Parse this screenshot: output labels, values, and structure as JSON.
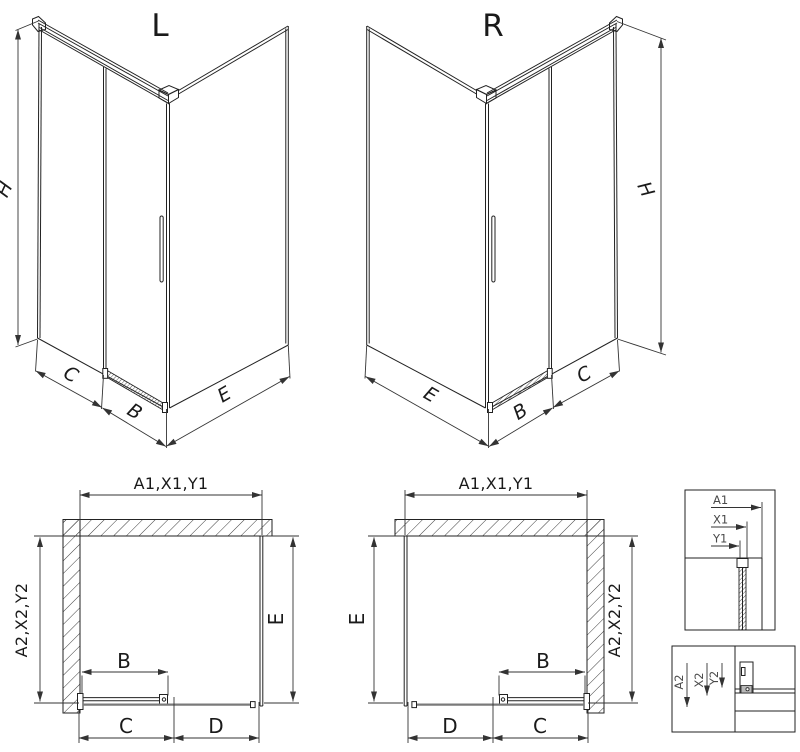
{
  "iso_left": {
    "letter": "L",
    "dim_h": "H",
    "dim_c": "C",
    "dim_b": "B",
    "dim_e": "E"
  },
  "iso_right": {
    "letter": "R",
    "dim_h": "H",
    "dim_e": "E",
    "dim_b": "B",
    "dim_c": "C"
  },
  "plan_left": {
    "dim_top": "A1,X1,Y1",
    "dim_side": "A2,X2,Y2",
    "dim_e": "E",
    "dim_b": "B",
    "dim_c": "C",
    "dim_d": "D"
  },
  "plan_right": {
    "dim_top": "A1,X1,Y1",
    "dim_side": "A2,X2,Y2",
    "dim_e": "E",
    "dim_b": "B",
    "dim_c": "C",
    "dim_d": "D"
  },
  "detail_top": {
    "dim_a1": "A1",
    "dim_x1": "X1",
    "dim_y1": "Y1"
  },
  "detail_bottom": {
    "dim_a2": "A2",
    "dim_x2": "X2",
    "dim_y2": "Y2"
  },
  "colors": {
    "line": "#222222",
    "dimension": "#333333",
    "label": "#1a1a1a",
    "detail_label": "#4a4a4a",
    "rail_gray": "#7a7a7a",
    "background": "#ffffff"
  }
}
